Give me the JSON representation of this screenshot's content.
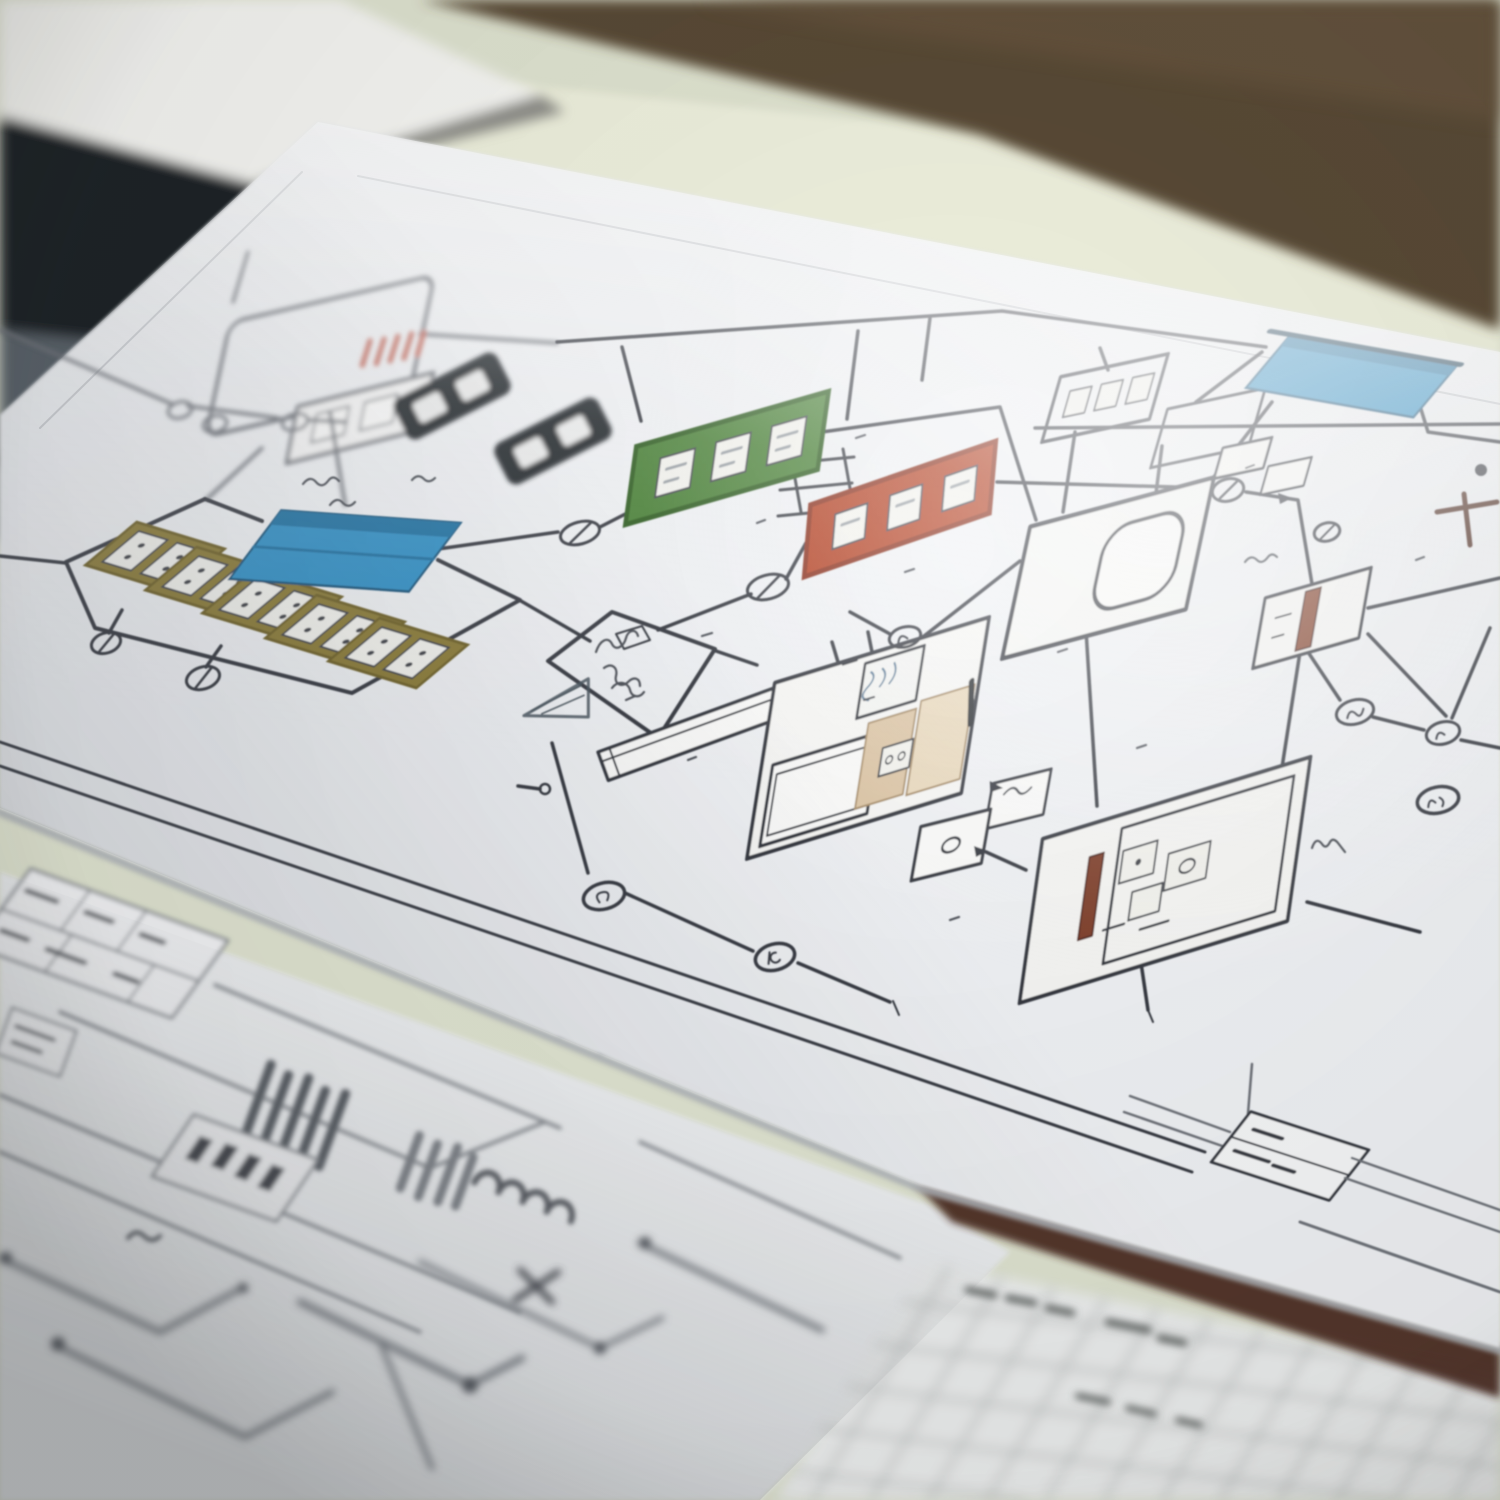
{
  "scene": {
    "type": "photograph",
    "subject": "hand-drawn wiring schematic sheets on a desk",
    "background": {
      "wall": "#594a35",
      "wall_light": "#6a5740",
      "desk": "#dfe3d0",
      "desk_highlight": "#eef0dd",
      "dark_object": "#1d2025",
      "dark_object_band": "#596067",
      "white_object": "#f6f6f3"
    },
    "papers": {
      "top_sheet": {
        "fill": "#f0f2f5",
        "highlight": "#ffffff",
        "shadow_edge": "#aeb2b8"
      },
      "bottom_left_sheet": {
        "fill": "#edeff1"
      },
      "grid_sheet": {
        "fill": "#eceeee",
        "grid_line": "#a2a6a3"
      },
      "folder_edge": "#46281f"
    },
    "ink": {
      "line": "#343840",
      "soft": "#6d7178",
      "blur_line": "#85898f"
    },
    "components": {
      "blue": "#2f8fc6",
      "blue_dark": "#1d6fa2",
      "blue_edge": "#10324a",
      "green": "#447e30",
      "red": "#b23a1d",
      "olive": "#8a7a35",
      "tan": "#dcc5a5",
      "tan_light": "#e9d9bd",
      "dark_red_bar": "#7c3a26",
      "dark_red_bar2": "#83402c",
      "pink_hatch": "#c4685a",
      "black_block": "#1e2126",
      "funnel_blue": "#b9cdd9",
      "scribble_blue": "#5d7f9b",
      "tee_mark": "#55342a"
    }
  }
}
